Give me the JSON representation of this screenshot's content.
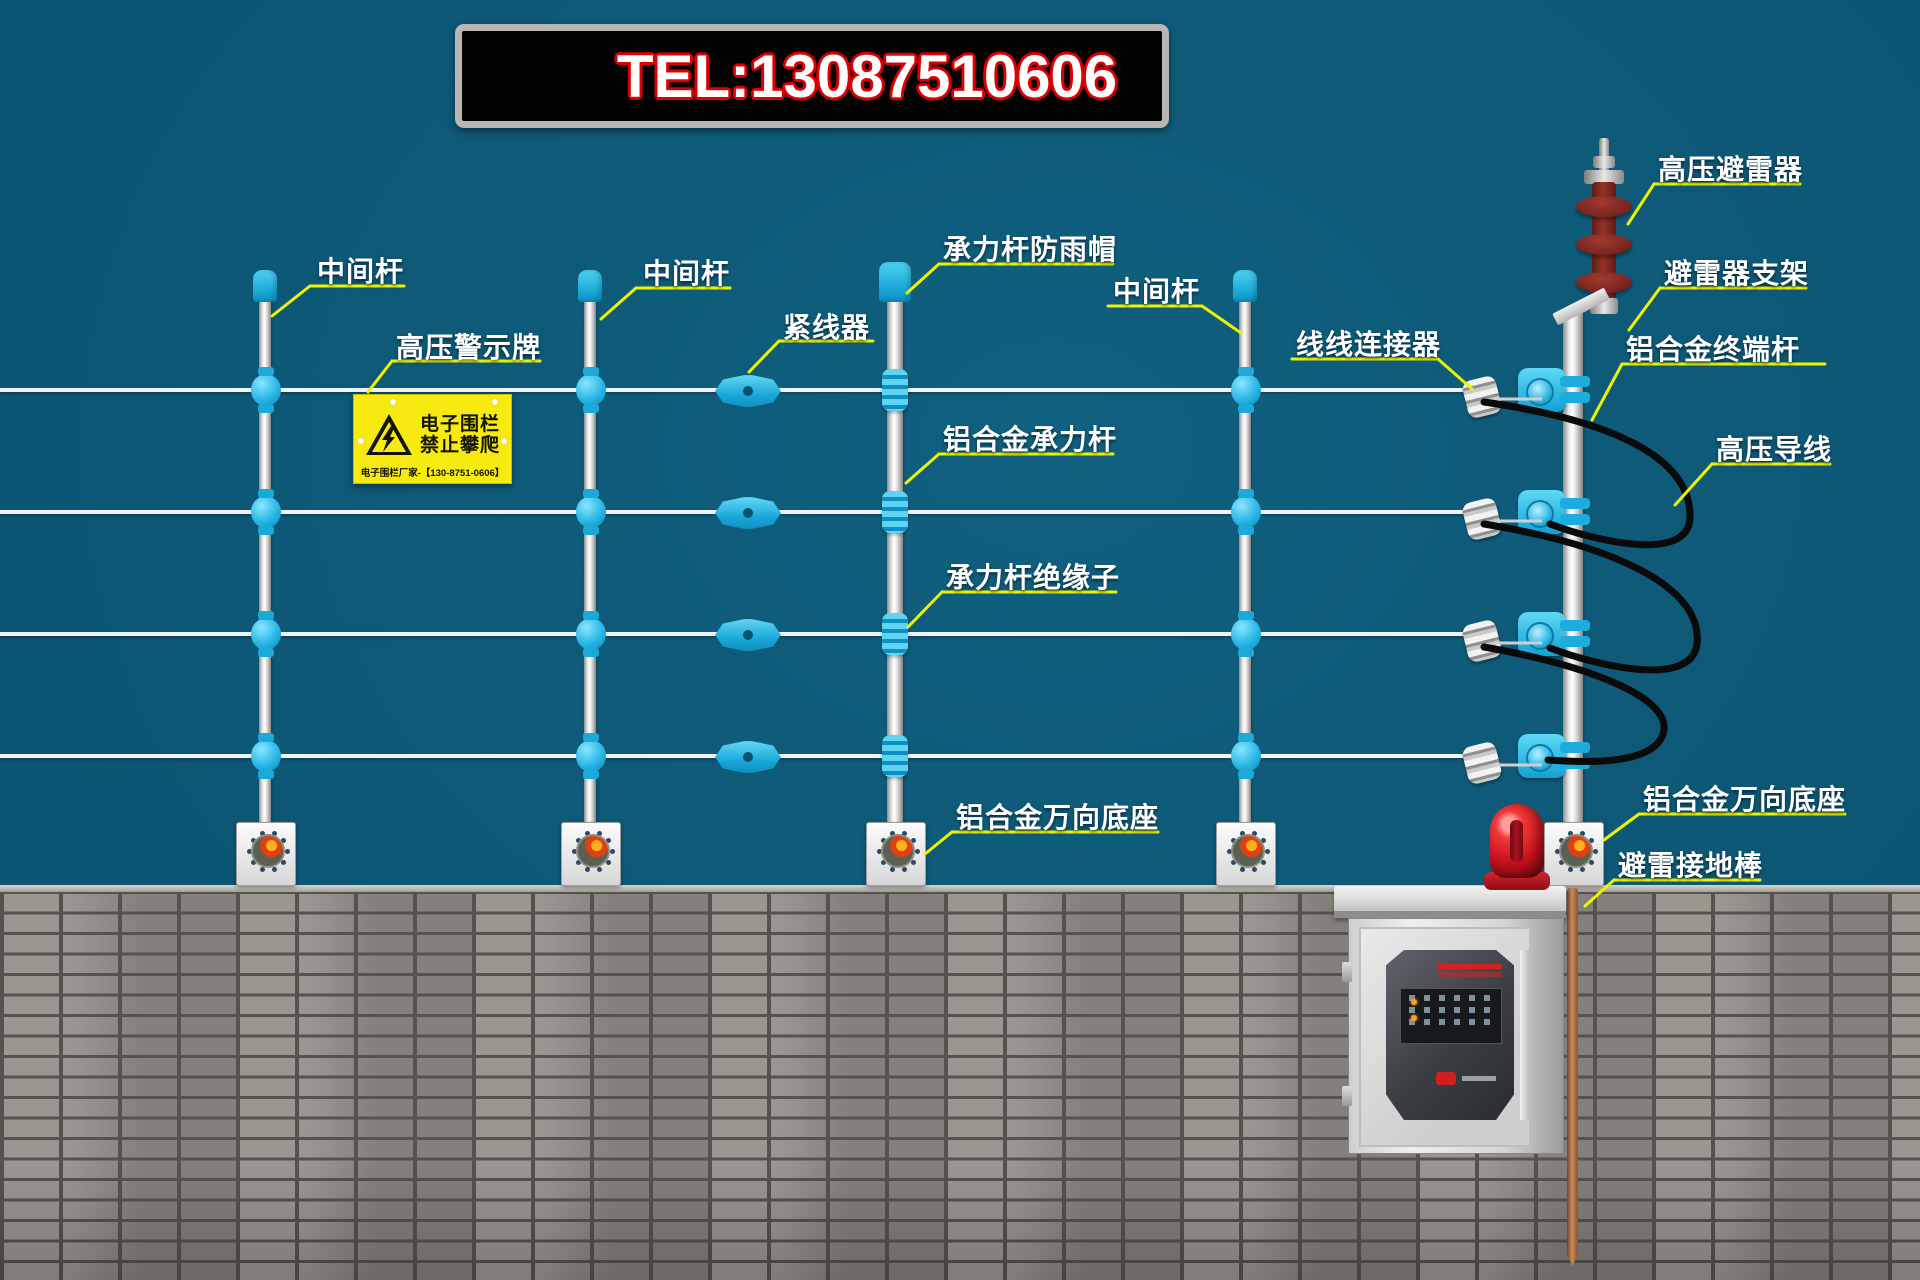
{
  "banner": {
    "phone_label": "TEL:13087510606"
  },
  "callouts": [
    {
      "id": "mid-pole-1",
      "text": "中间杆"
    },
    {
      "id": "hv-warning-sign",
      "text": "高压警示牌"
    },
    {
      "id": "mid-pole-2",
      "text": "中间杆"
    },
    {
      "id": "wire-tensioner",
      "text": "紧线器"
    },
    {
      "id": "bearing-pole-rain-cap",
      "text": "承力杆防雨帽"
    },
    {
      "id": "mid-pole-3",
      "text": "中间杆"
    },
    {
      "id": "aluminum-bearing-pole",
      "text": "铝合金承力杆"
    },
    {
      "id": "bearing-pole-insulator",
      "text": "承力杆绝缘子"
    },
    {
      "id": "universal-base-left",
      "text": "铝合金万向底座"
    },
    {
      "id": "wire-to-wire-connector",
      "text": "线线连接器"
    },
    {
      "id": "hv-lightning-arrester",
      "text": "高压避雷器"
    },
    {
      "id": "arrester-bracket",
      "text": "避雷器支架"
    },
    {
      "id": "aluminum-terminal-pole",
      "text": "铝合金终端杆"
    },
    {
      "id": "hv-conductor-wire",
      "text": "高压导线"
    },
    {
      "id": "universal-base-right",
      "text": "铝合金万向底座"
    },
    {
      "id": "lightning-ground-rod",
      "text": "避雷接地棒"
    }
  ],
  "warning_sign": {
    "line1": "电子围栏",
    "line2": "禁止攀爬",
    "footer": "电子围栏厂家-【130-8751-0606】"
  },
  "colors": {
    "background_teal": "#0d5876",
    "accent_yellow": "#edf400",
    "fitting_cyan": "#1aa9d8",
    "sign_yellow": "#f6ea10",
    "banner_red": "#dc0000",
    "arrester_red": "#7c2721",
    "beacon_red": "#c3101c",
    "ground_rod_copper": "#c98a58"
  }
}
